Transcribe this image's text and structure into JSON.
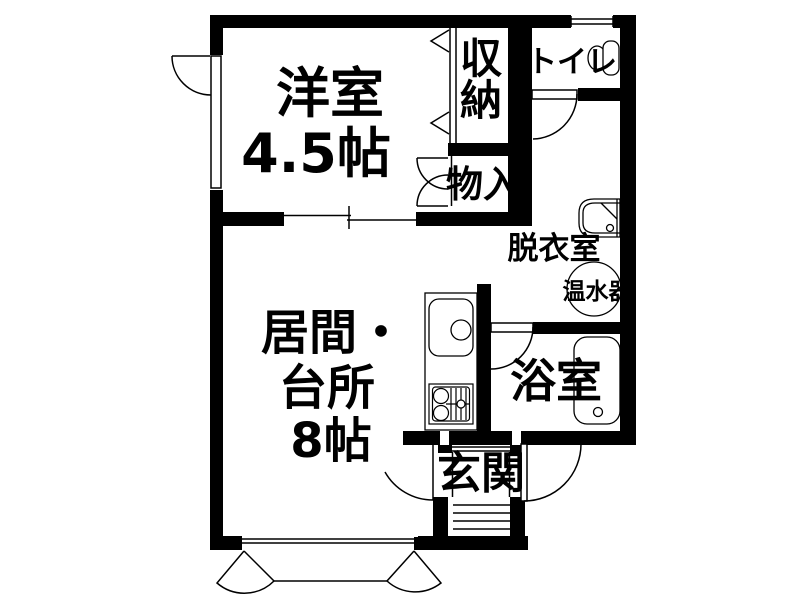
{
  "floorplan": {
    "background": "#ffffff",
    "wall_color": "#000000",
    "line_color": "#000000",
    "text_color": "#000000",
    "labels": {
      "yoshitsu": "洋室",
      "yoshitsu_size": "4.5帖",
      "shuno": "収納",
      "toire": "トイレ",
      "monoire": "物入",
      "datsuishitsu": "脱衣室",
      "onsuiki": "温水器",
      "ima": "居間・",
      "daidokoro": "台所",
      "ima_size": "8帖",
      "yokushitsu": "浴室",
      "genkan": "玄関"
    }
  }
}
